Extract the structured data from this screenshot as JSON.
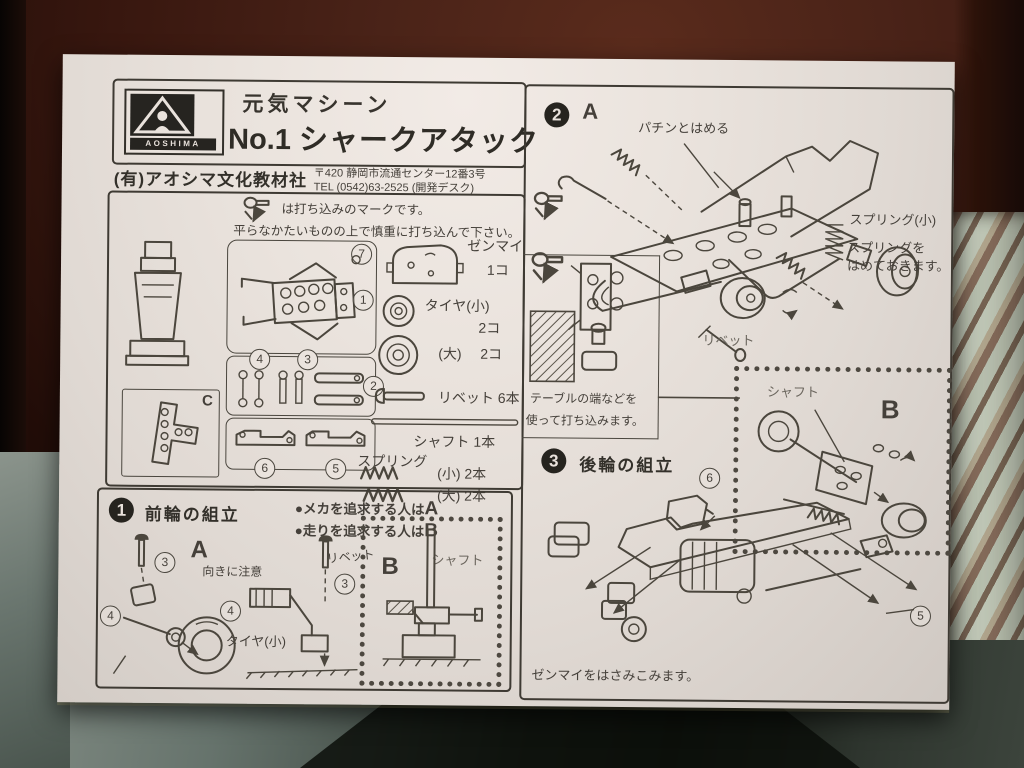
{
  "colors": {
    "paper": "#eae3dd",
    "ink": "#3e3a33",
    "wood": "#4a2318",
    "fabric_right": "#ccd4c2",
    "fabric_bottom": "#66736c"
  },
  "header": {
    "brand": "AOSHIMA",
    "series": "元気マシーン",
    "title_no": "No.1",
    "title": "シャークアタック",
    "company": "(有)アオシマ文化教材社",
    "address": "〒420 静岡市流通センター12番3号",
    "tel": "TEL (0542)63-2525 (開発デスク)"
  },
  "stamp_note": {
    "line1": "は打ち込みのマークです。",
    "line2": "平らなかたいものの上で慎重に打ち込んで下さい。"
  },
  "parts": {
    "sprue_letter": "C",
    "callouts": {
      "c1": "1",
      "c2": "2",
      "c3": "3",
      "c4": "4",
      "c5": "5",
      "c6": "6",
      "c7": "7"
    },
    "list": [
      {
        "name": "ゼンマイ",
        "qty": "1コ"
      },
      {
        "name": "タイヤ(小)",
        "qty": "2コ"
      },
      {
        "name": "(大)",
        "qty": "2コ"
      },
      {
        "name": "リベット 6本",
        "qty": ""
      },
      {
        "name": "シャフト 1本",
        "qty": ""
      }
    ],
    "spring": {
      "label": "スプリング",
      "small": "(小) 2本",
      "large": "(大) 2本"
    }
  },
  "section1": {
    "num": "1",
    "title": "前輪の組立",
    "bullet_a_text": "●メカを追求する人は",
    "bullet_a_letter": "A",
    "bullet_b_text": "●走りを追求する人は",
    "bullet_b_letter": "B",
    "variant_a": "A",
    "note_direction": "向きに注意",
    "label_rivet": "リベット",
    "label_tire": "タイヤ(小)",
    "b_box": {
      "letter": "B",
      "label_shaft": "シャフト"
    }
  },
  "section2": {
    "num": "2",
    "variant": "A",
    "label_snap": "パチンとはめる",
    "label_spring_small": "スプリング(小)",
    "note_spring1": "スプリングを",
    "note_spring2": "はめておきます。",
    "label_rivet": "リベット",
    "table_note1": "テーブルの端などを",
    "table_note2": "使って打ち込みます。",
    "b_box": {
      "letter": "B",
      "label_shaft": "シャフト"
    }
  },
  "section3": {
    "num": "3",
    "title": "後輪の組立",
    "note": "ゼンマイをはさみこみます。"
  }
}
